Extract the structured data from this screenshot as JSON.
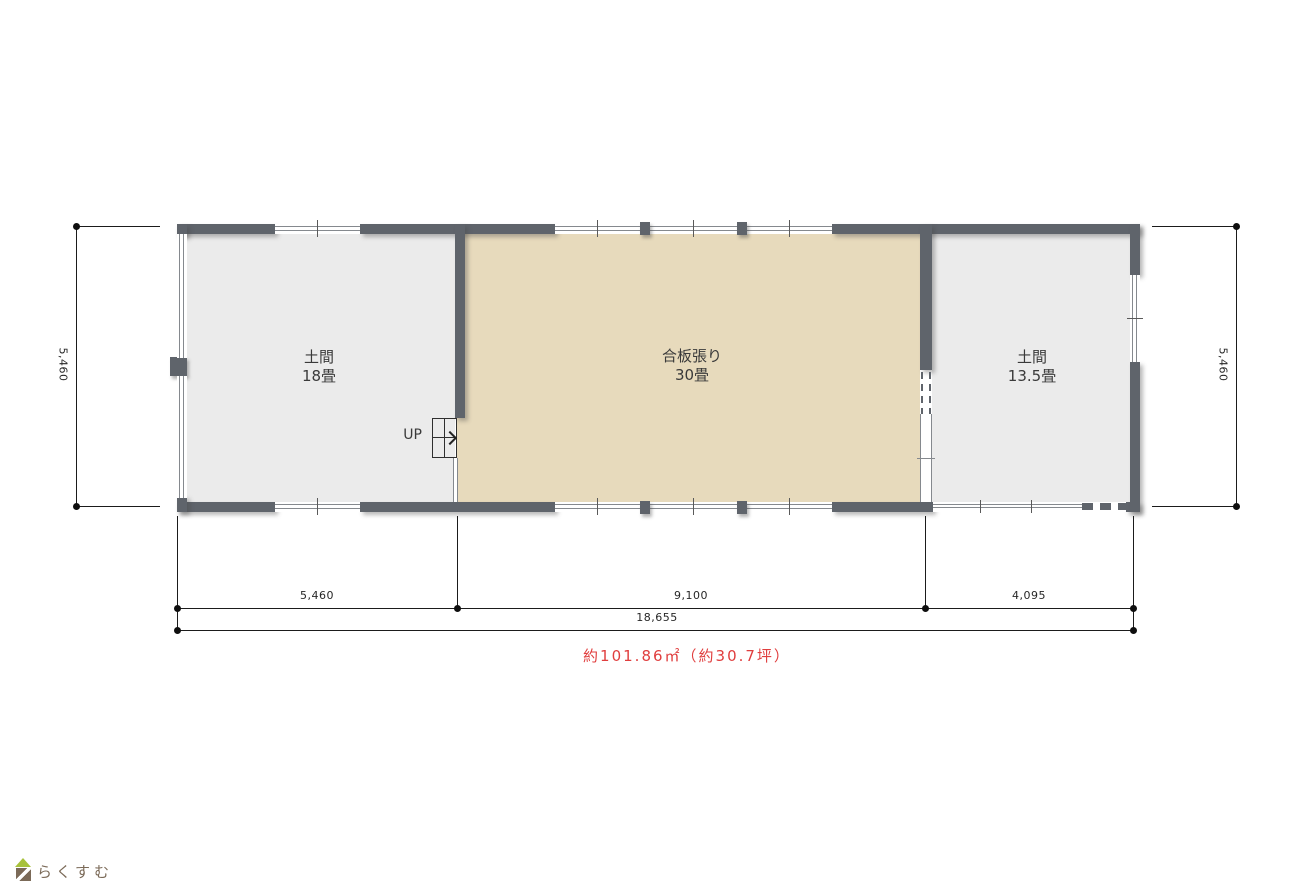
{
  "rooms": [
    {
      "line1": "土間",
      "line2": "18畳"
    },
    {
      "line1": "合板張り",
      "line2": "30畳"
    },
    {
      "line1": "土間",
      "line2": "13.5畳"
    }
  ],
  "stairs": {
    "label": "UP"
  },
  "dims": {
    "left_vertical": "5,460",
    "right_vertical": "5,460",
    "bottom": [
      "5,460",
      "9,100",
      "4,095"
    ],
    "total": "18,655"
  },
  "area_note": "約101.86㎡（約30.7坪）",
  "logo": {
    "text": "らくすむ",
    "icon": "house-icon"
  },
  "colors": {
    "wall": "#5f646b",
    "floor_gray": "#ebebeb",
    "floor_wood": "#e7dabc",
    "area_note_text": "#e03e3e",
    "logo_roof": "#a8c23c",
    "logo_brown": "#7b6a58"
  }
}
